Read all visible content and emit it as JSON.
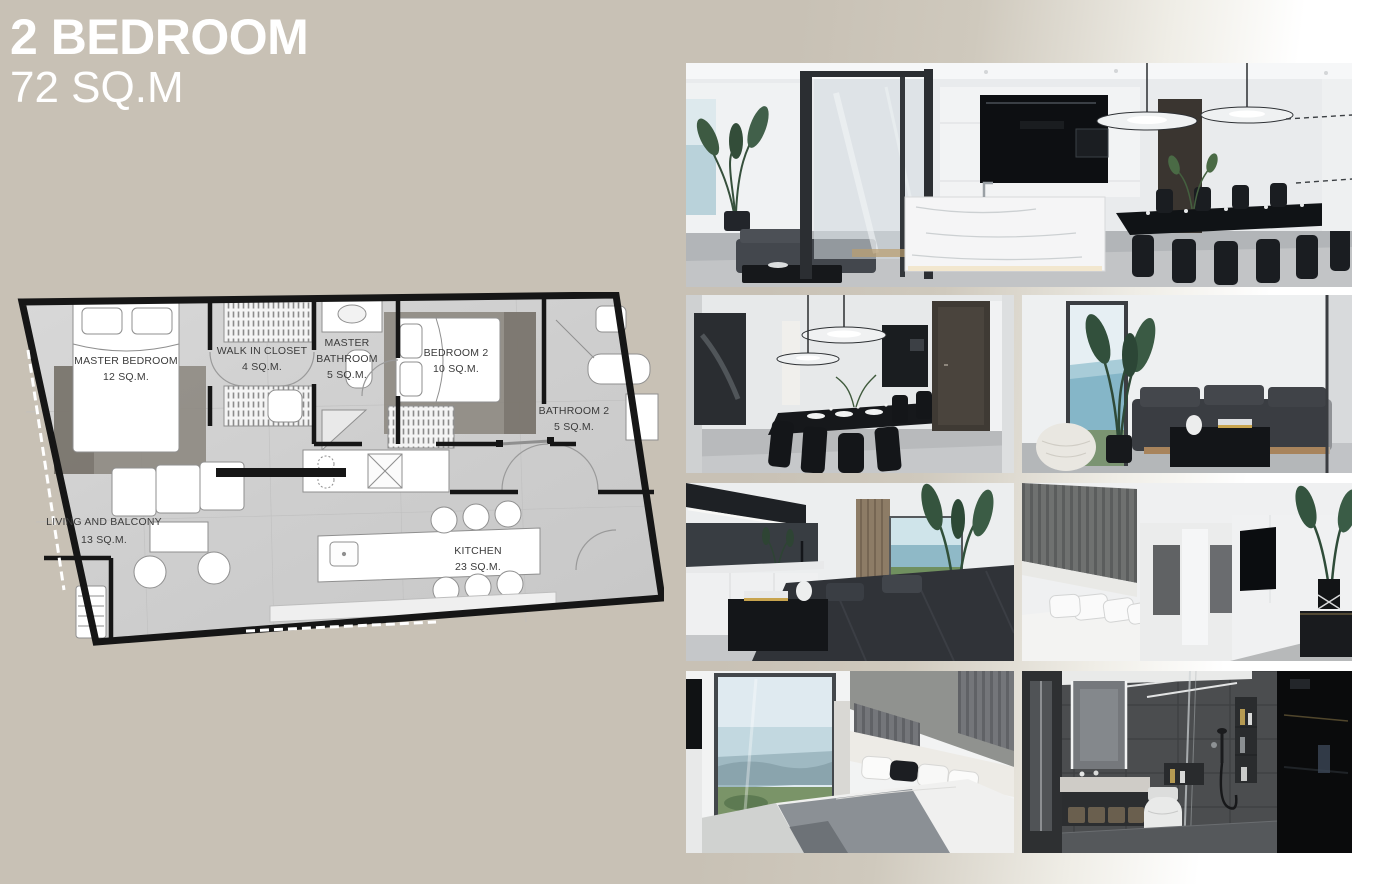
{
  "page": {
    "background_color": "#c8c1b5",
    "title_color": "#ffffff"
  },
  "header": {
    "title": "2 BEDROOM",
    "subtitle": "72 SQ.M"
  },
  "floor_plan": {
    "wall_color": "#161616",
    "floor_color": "#d3d3d3",
    "rooms": [
      {
        "id": "master-bedroom",
        "label_lines": [
          "MASTER BEDROOM",
          "12 SQ.M."
        ]
      },
      {
        "id": "walk-in-closet",
        "label_lines": [
          "WALK IN CLOSET",
          "4 SQ.M."
        ]
      },
      {
        "id": "master-bathroom",
        "label_lines": [
          "MASTER",
          "BATHROOM",
          "5 SQ.M."
        ]
      },
      {
        "id": "bedroom-2",
        "label_lines": [
          "BEDROOM 2",
          "10 SQ.M."
        ]
      },
      {
        "id": "bathroom-2",
        "label_lines": [
          "BATHROOM 2",
          "5 SQ.M."
        ]
      },
      {
        "id": "living-and-balcony",
        "label_lines": [
          "LIVING AND BALCONY",
          "13 SQ.M."
        ]
      },
      {
        "id": "kitchen",
        "label_lines": [
          "KITCHEN",
          "23 SQ.M."
        ]
      }
    ]
  },
  "gallery": {
    "photos": [
      {
        "name": "kitchen-and-dining-room"
      },
      {
        "name": "dining-area"
      },
      {
        "name": "living-room-sea-view"
      },
      {
        "name": "living-room-and-balcony"
      },
      {
        "name": "bedroom-with-tv"
      },
      {
        "name": "bedroom-panoramic-window"
      },
      {
        "name": "bathroom"
      }
    ]
  }
}
